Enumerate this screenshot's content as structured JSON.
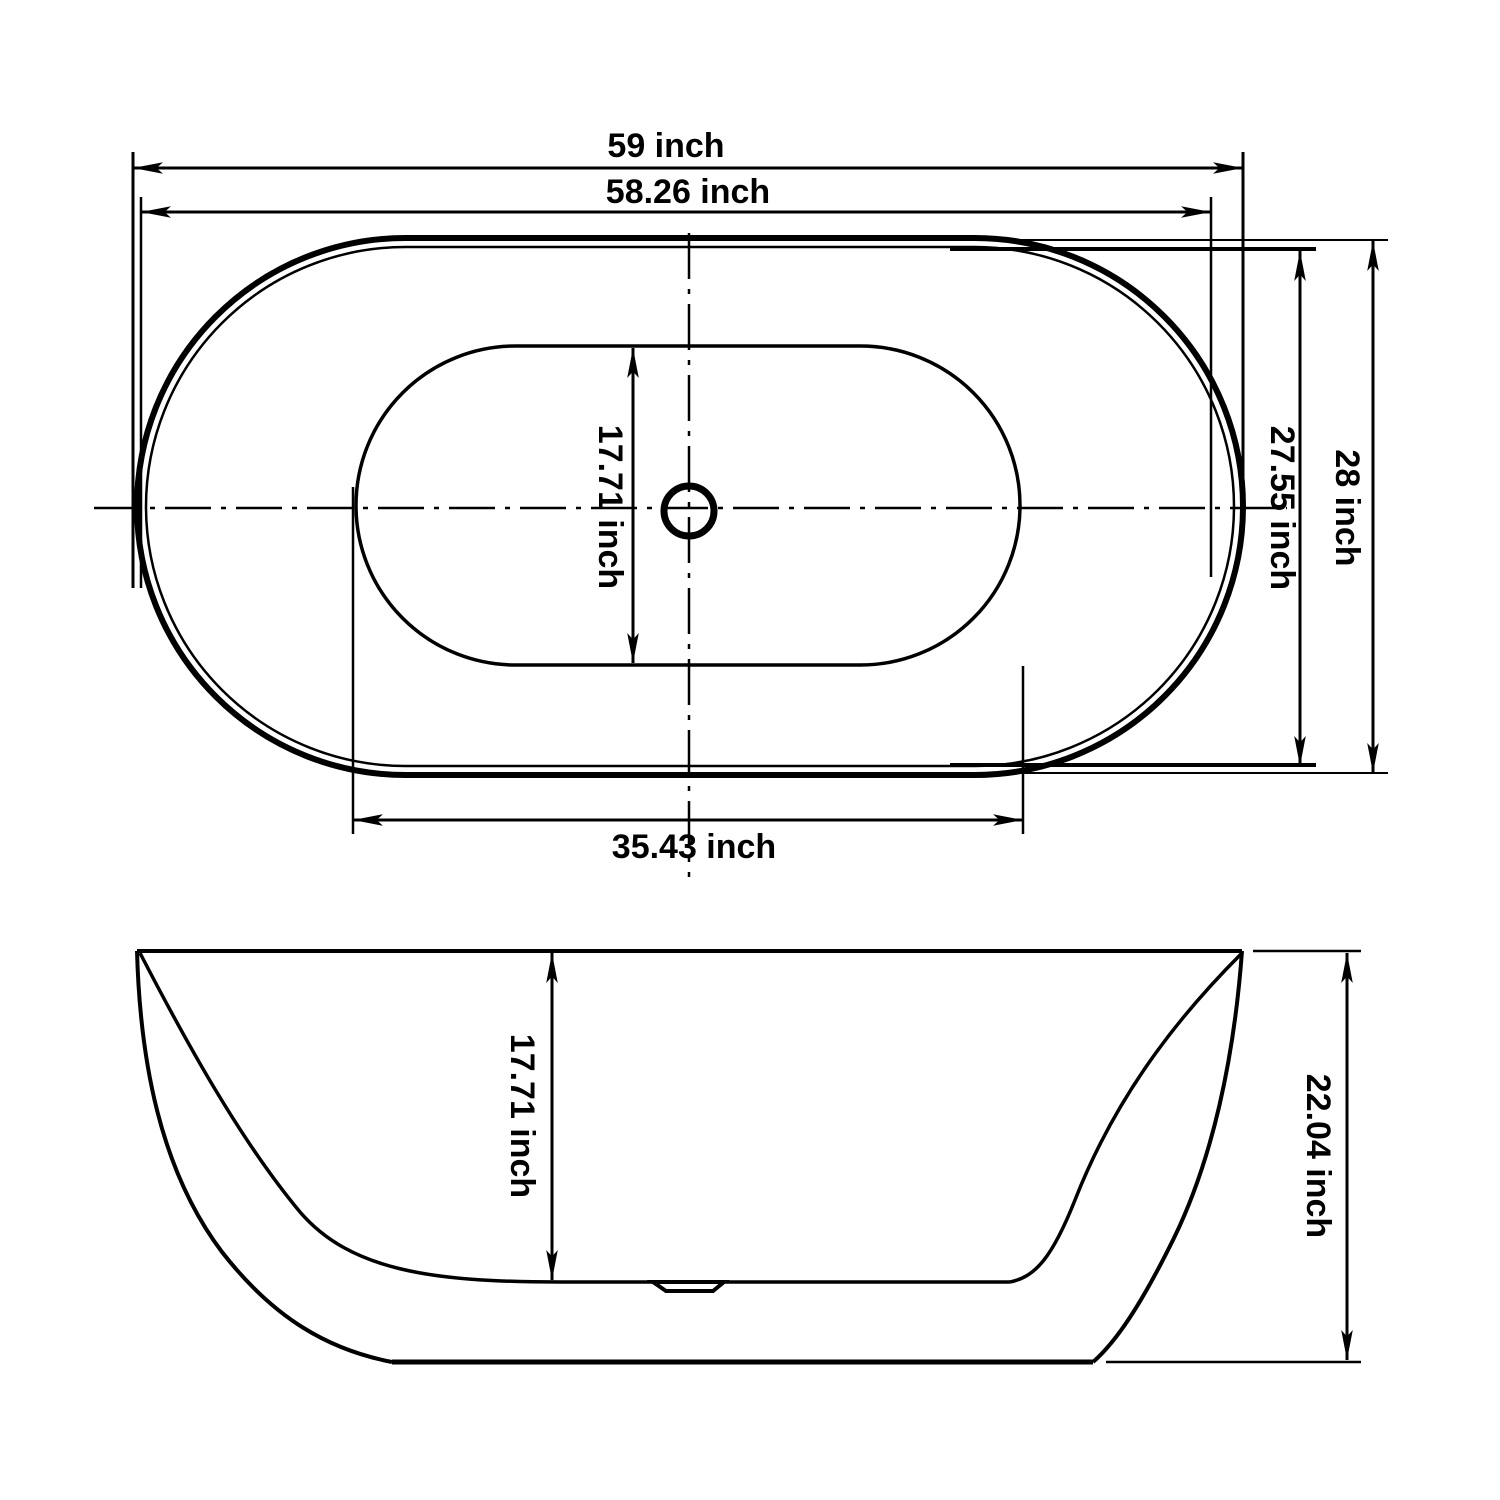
{
  "drawing": {
    "type": "bathtub-dimension-diagram",
    "unit": "inch",
    "colors": {
      "line": "#000000",
      "background": "#ffffff"
    },
    "top_view": {
      "overall_length_label": "59 inch",
      "rim_inner_length_label": "58.26 inch",
      "overall_width_label": "28 inch",
      "rim_inner_width_label": "27.55 inch",
      "basin_length_label": "35.43 inch",
      "basin_width_label": "17.71 inch"
    },
    "side_view": {
      "inner_depth_label": "17.71 inch",
      "overall_height_label": "22.04 inch"
    }
  }
}
